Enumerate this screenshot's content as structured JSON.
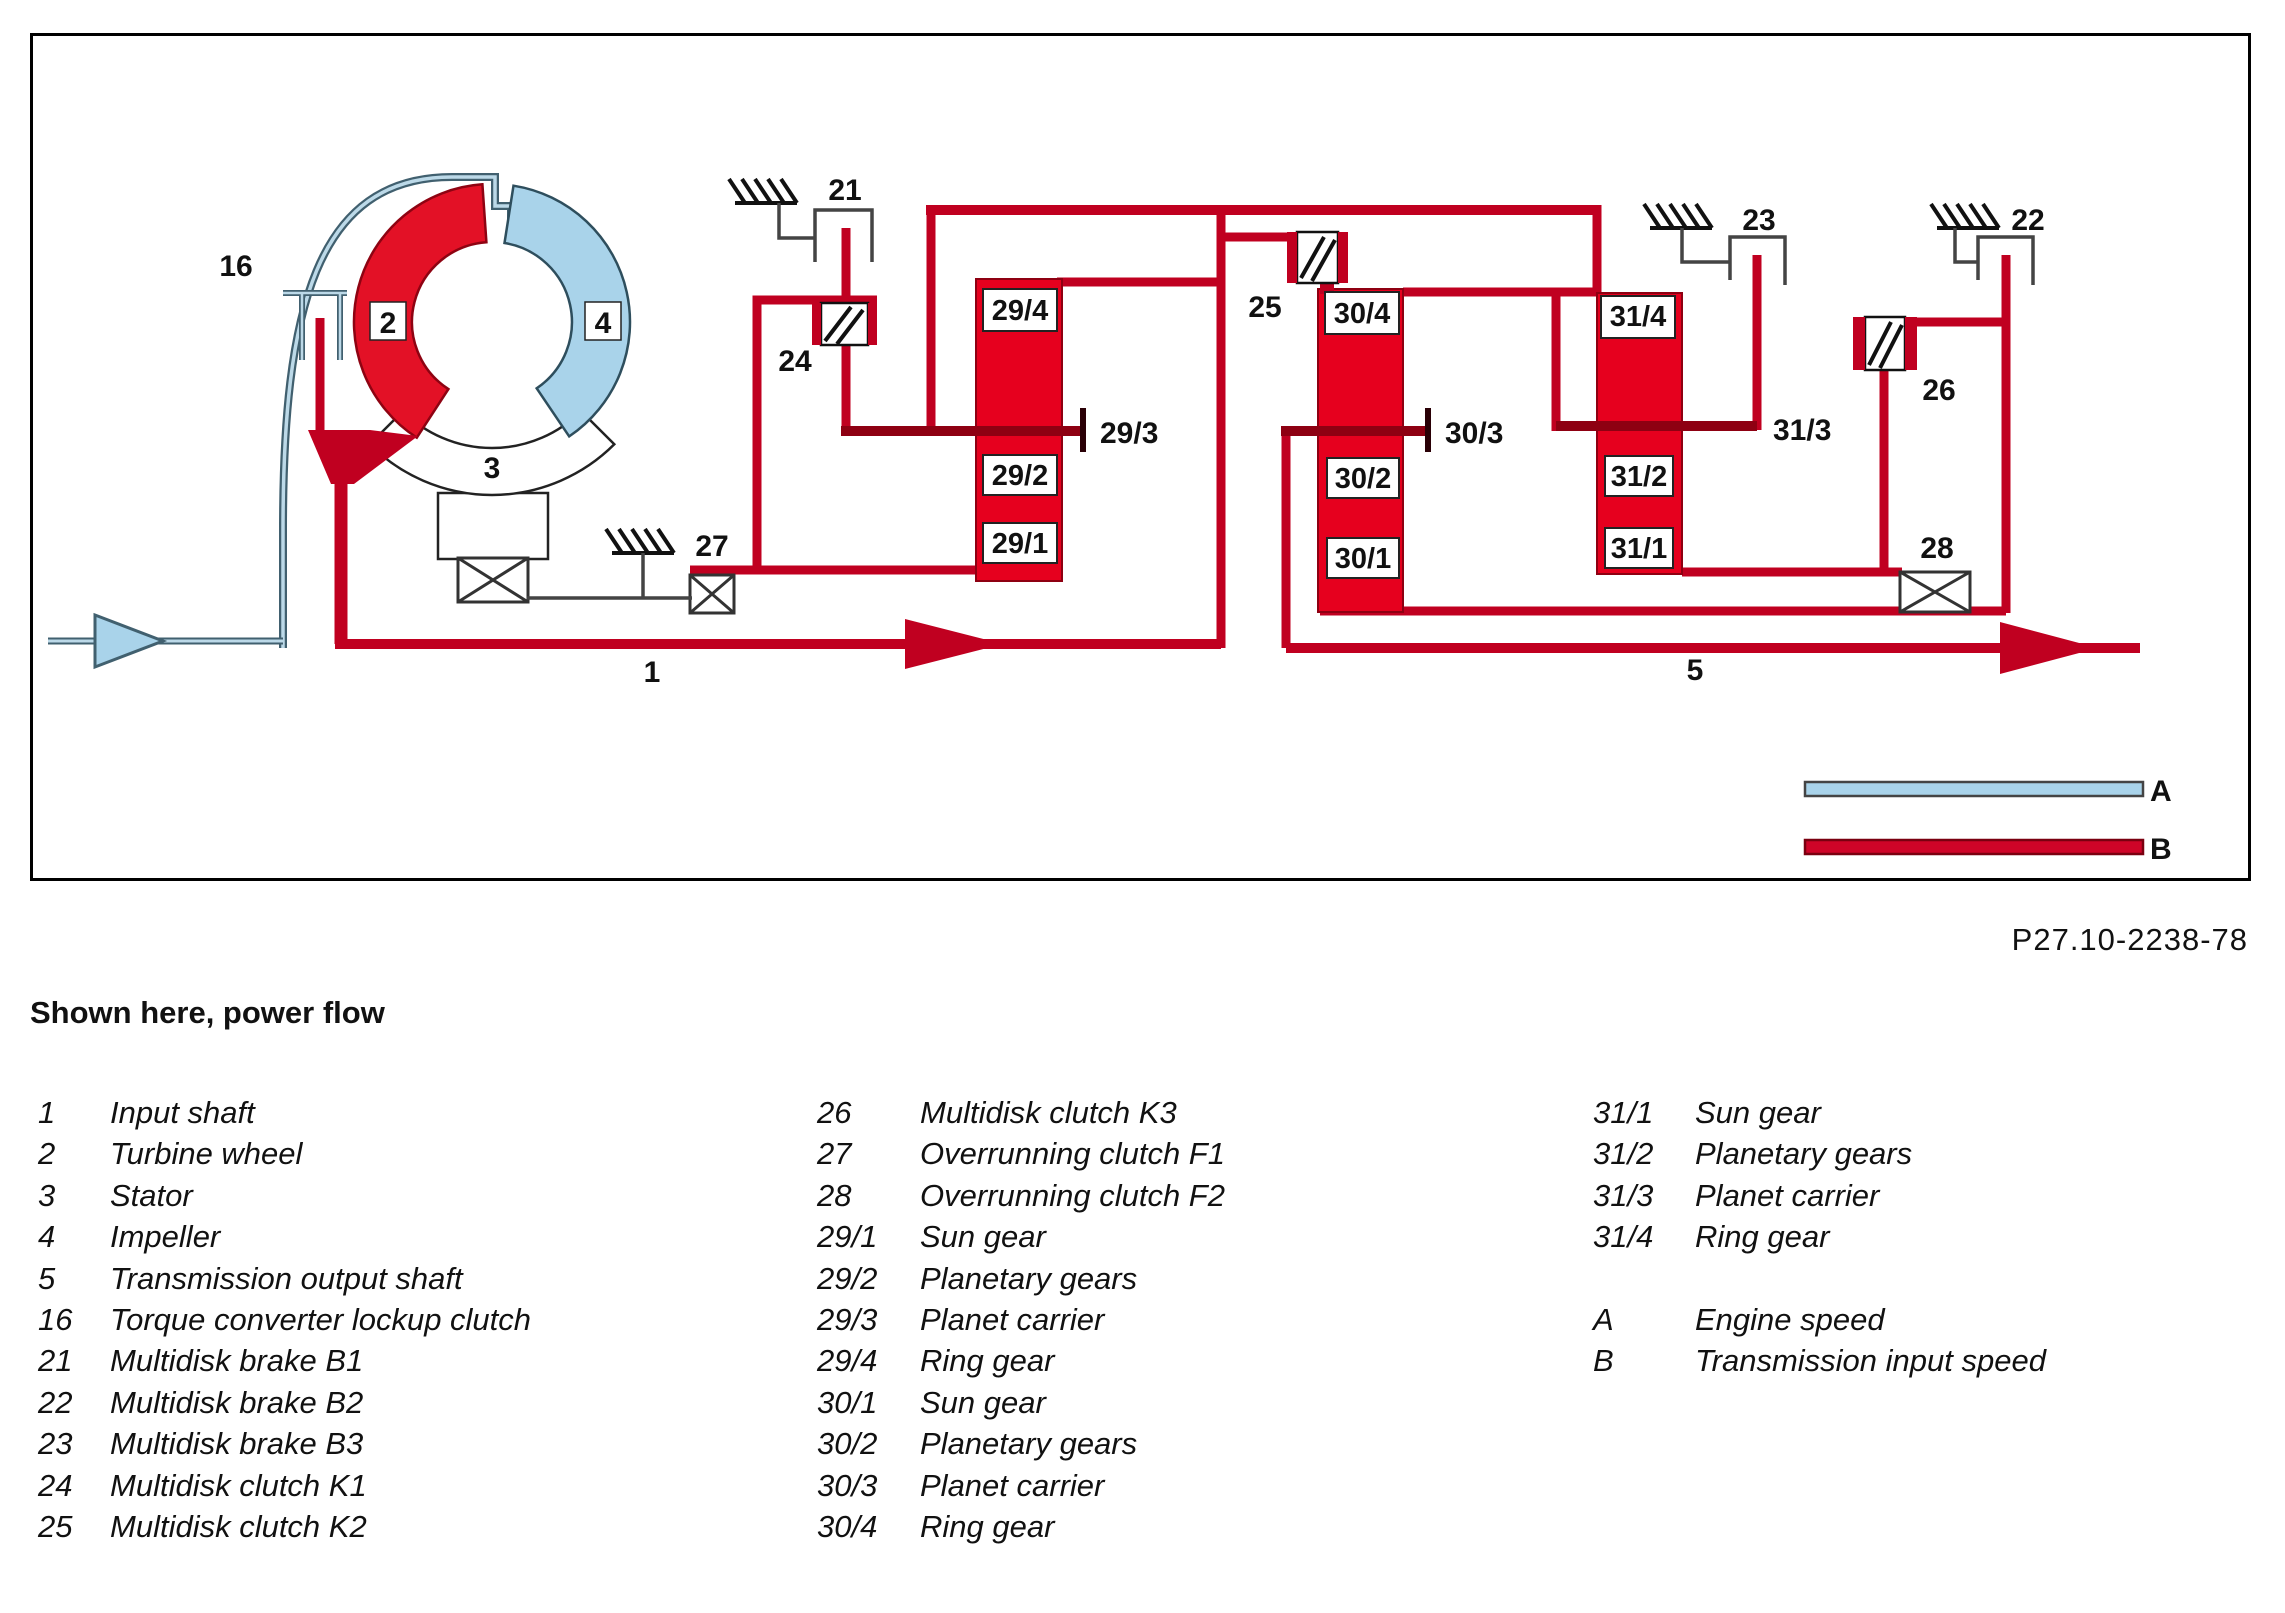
{
  "header": {
    "code": "P27.10-2238-78",
    "caption": "Shown here, power flow"
  },
  "diagram": {
    "colors": {
      "red_line": "#c00020",
      "red_fill": "#e6001e",
      "red_dark": "#8e0012",
      "blue_fill": "#a9d3ea",
      "blue_edge": "#41606f",
      "gray_line": "#444444"
    },
    "labels": {
      "n1": "1",
      "n2": "2",
      "n3": "3",
      "n4": "4",
      "n5": "5",
      "n16": "16",
      "n21": "21",
      "n22": "22",
      "n23": "23",
      "n24": "24",
      "n25": "25",
      "n26": "26",
      "n27": "27",
      "n28": "28",
      "g29_1": "29/1",
      "g29_2": "29/2",
      "t29_3": "29/3",
      "g29_4": "29/4",
      "g30_1": "30/1",
      "g30_2": "30/2",
      "t30_3": "30/3",
      "g30_4": "30/4",
      "g31_1": "31/1",
      "g31_2": "31/2",
      "t31_3": "31/3",
      "g31_4": "31/4",
      "a": "A",
      "b": "B"
    }
  },
  "legend": {
    "col1": [
      {
        "num": "1",
        "label": "Input shaft"
      },
      {
        "num": "2",
        "label": "Turbine wheel"
      },
      {
        "num": "3",
        "label": "Stator"
      },
      {
        "num": "4",
        "label": "Impeller"
      },
      {
        "num": "5",
        "label": "Transmission output shaft"
      },
      {
        "num": "16",
        "label": "Torque converter lockup clutch"
      },
      {
        "num": "21",
        "label": "Multidisk brake B1"
      },
      {
        "num": "22",
        "label": "Multidisk brake B2"
      },
      {
        "num": "23",
        "label": "Multidisk brake B3"
      },
      {
        "num": "24",
        "label": "Multidisk clutch K1"
      },
      {
        "num": "25",
        "label": "Multidisk clutch K2"
      }
    ],
    "col2": [
      {
        "num": "26",
        "label": "Multidisk clutch K3"
      },
      {
        "num": "27",
        "label": "Overrunning clutch F1"
      },
      {
        "num": "28",
        "label": "Overrunning clutch F2"
      },
      {
        "num": "29/1",
        "label": "Sun gear"
      },
      {
        "num": "29/2",
        "label": "Planetary gears"
      },
      {
        "num": "29/3",
        "label": "Planet carrier"
      },
      {
        "num": "29/4",
        "label": "Ring gear"
      },
      {
        "num": "30/1",
        "label": "Sun gear"
      },
      {
        "num": "30/2",
        "label": "Planetary gears"
      },
      {
        "num": "30/3",
        "label": "Planet carrier"
      },
      {
        "num": "30/4",
        "label": "Ring gear"
      }
    ],
    "col3": [
      {
        "num": "31/1",
        "label": "Sun gear"
      },
      {
        "num": "31/2",
        "label": "Planetary gears"
      },
      {
        "num": "31/3",
        "label": "Planet carrier"
      },
      {
        "num": "31/4",
        "label": "Ring gear"
      }
    ],
    "col3b": [
      {
        "num": "A",
        "label": "Engine speed"
      },
      {
        "num": "B",
        "label": "Transmission input speed"
      }
    ]
  }
}
